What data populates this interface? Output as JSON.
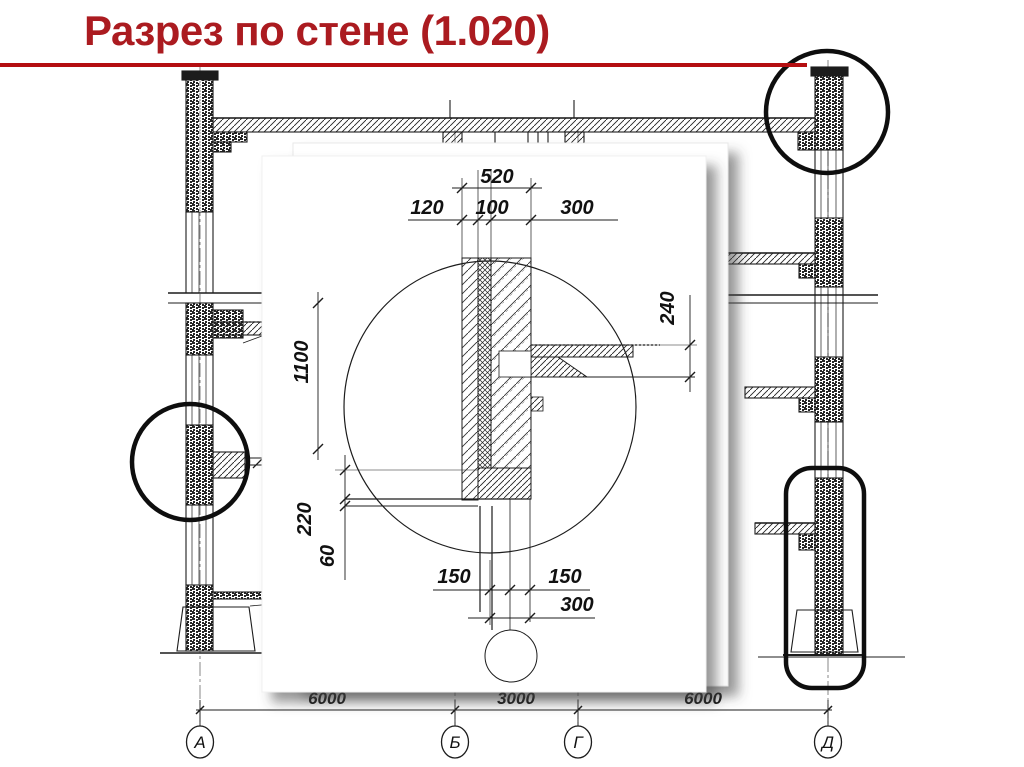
{
  "slide": {
    "title": "Разрез по стене (1.020)",
    "title_color": "#ab1b20",
    "rule_color": "#b40e11",
    "line_color": "#1c1c1c"
  },
  "drawing": {
    "axis_labels": [
      "А",
      "Б",
      "Г",
      "Д"
    ],
    "span_dims": [
      "6000",
      "3000",
      "6000"
    ]
  },
  "wall_detail_dims": {
    "total_width": "520",
    "layers": [
      "120",
      "100",
      "300"
    ],
    "height": "1100",
    "ledge": "220",
    "seam": "60",
    "slab_depth": "240",
    "base_left": "150",
    "base_right": "150",
    "base_total": "300"
  }
}
